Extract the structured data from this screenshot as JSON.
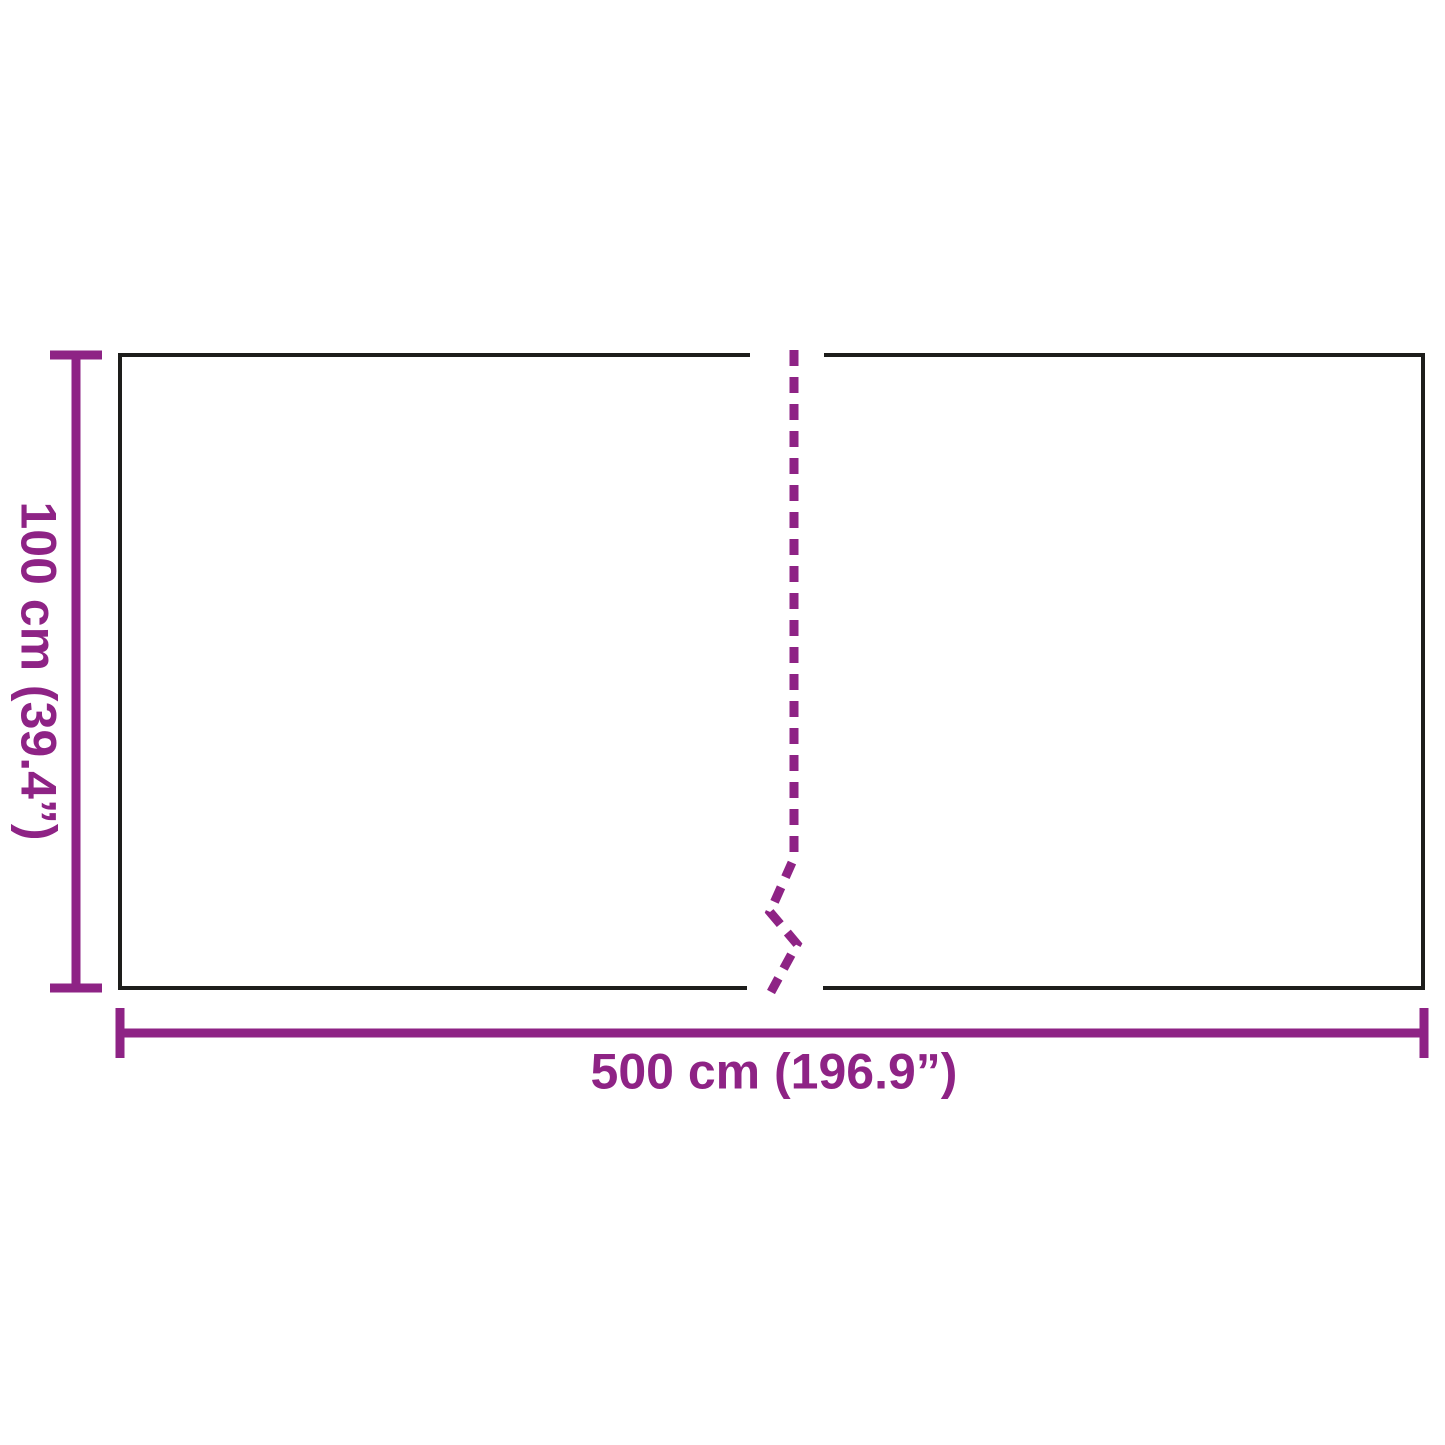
{
  "diagram": {
    "height_label": "100 cm (39.4”)",
    "width_label": "500 cm (196.9”)"
  },
  "colors": {
    "accent": "#8e2385",
    "outline": "#1d1d1b",
    "background": "#ffffff"
  }
}
